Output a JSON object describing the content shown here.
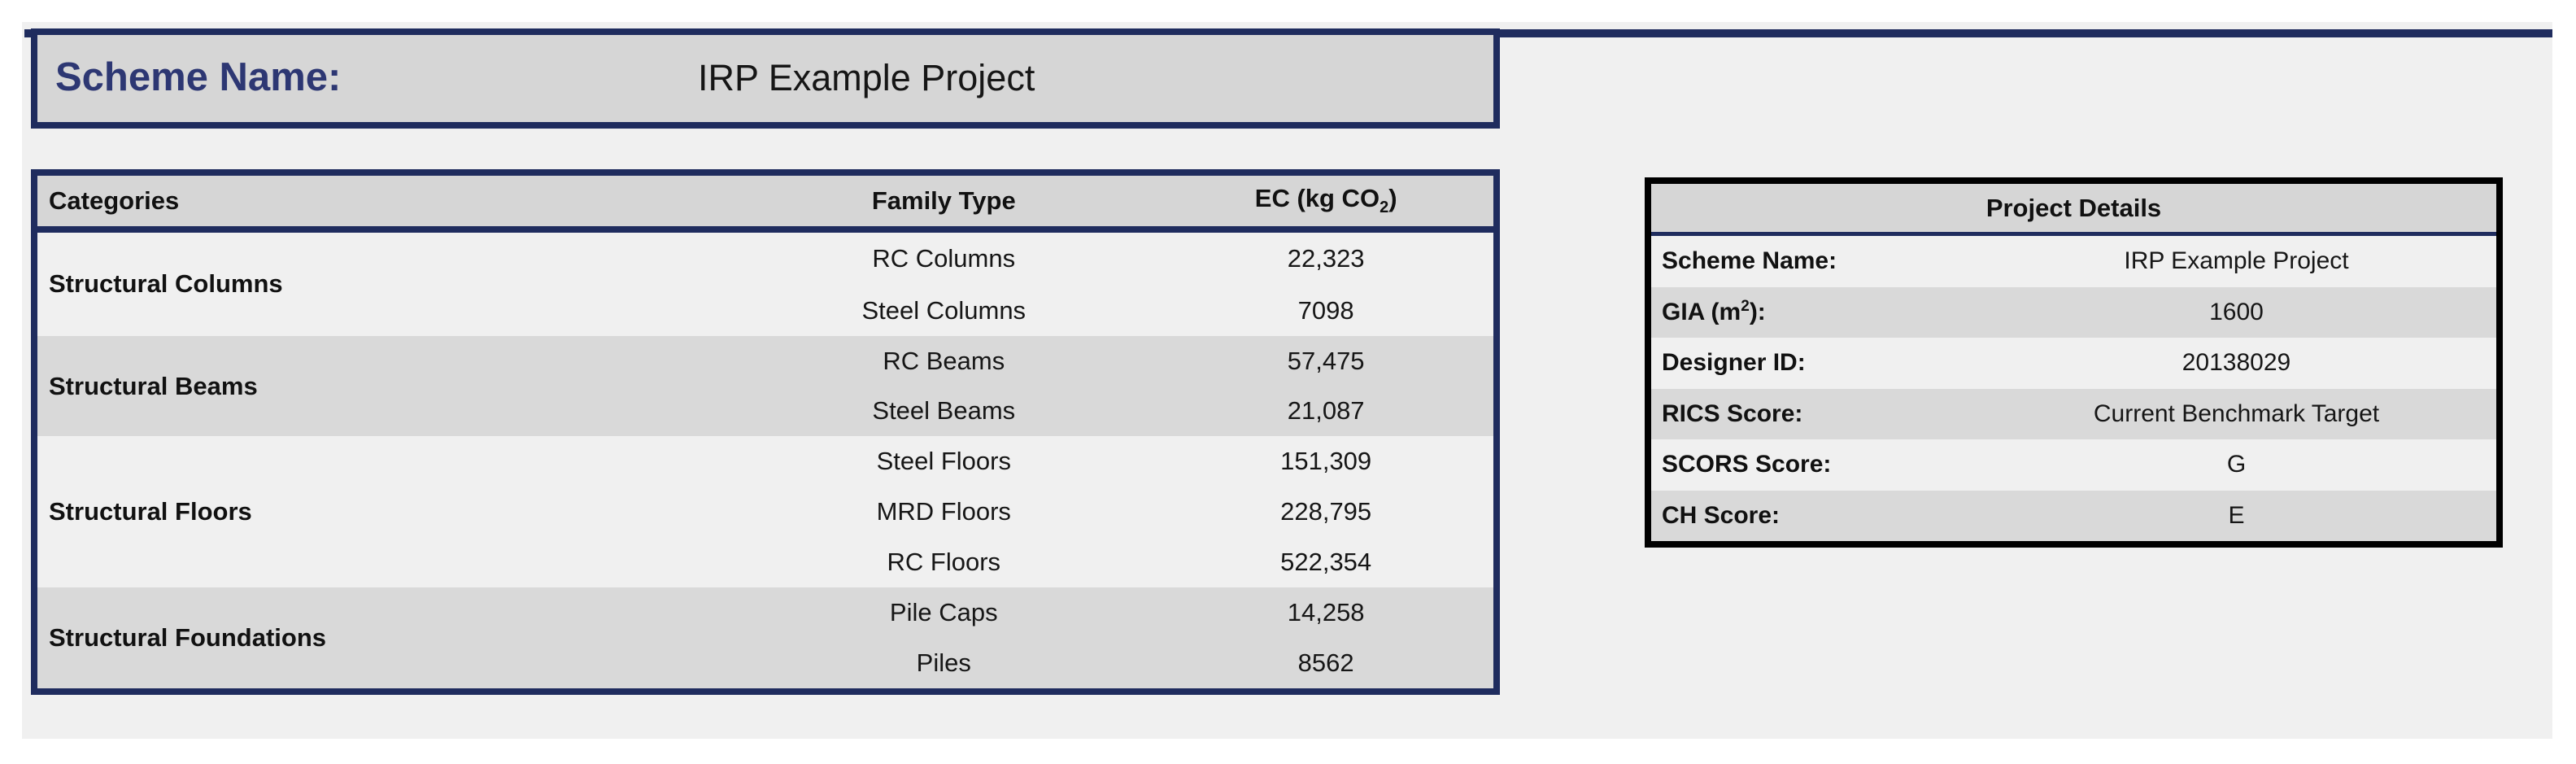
{
  "banner": {
    "label": "Scheme Name:",
    "value": "IRP Example Project"
  },
  "table": {
    "categories_header": "Categories",
    "family_header": "Family Type",
    "ec_header": {
      "prefix": "EC (kg CO",
      "sub": "2",
      "suffix": ")"
    },
    "groups": [
      {
        "category": "Structural Columns",
        "rows": [
          {
            "family": "RC Columns",
            "ec": "22,323"
          },
          {
            "family": "Steel Columns",
            "ec": "7098"
          }
        ]
      },
      {
        "category": "Structural Beams",
        "rows": [
          {
            "family": "RC Beams",
            "ec": "57,475"
          },
          {
            "family": "Steel Beams",
            "ec": "21,087"
          }
        ]
      },
      {
        "category": "Structural Floors",
        "rows": [
          {
            "family": "Steel Floors",
            "ec": "151,309"
          },
          {
            "family": "MRD Floors",
            "ec": "228,795"
          },
          {
            "family": "RC Floors",
            "ec": "522,354"
          }
        ]
      },
      {
        "category": "Structural Foundations",
        "rows": [
          {
            "family": "Pile Caps",
            "ec": "14,258"
          },
          {
            "family": "Piles",
            "ec": "8562"
          }
        ]
      }
    ]
  },
  "details": {
    "title": "Project Details",
    "scheme_name": {
      "label": "Scheme Name:",
      "value": "IRP Example Project"
    },
    "gia": {
      "label_prefix": "GIA (m",
      "label_sup": "2",
      "label_suffix": "):",
      "value": "1600"
    },
    "designer_id": {
      "label": "Designer ID:",
      "value": "20138029"
    },
    "rics": {
      "label": "RICS Score:",
      "value": "Current Benchmark Target"
    },
    "scors": {
      "label": "SCORS Score:",
      "value": "G"
    },
    "ch": {
      "label": "CH Score:",
      "value": "E"
    }
  },
  "colors": {
    "navy_border": "#1f2c5e",
    "title_blue": "#2d3773",
    "panel_border": "#000000",
    "header_gray": "#d6d6d6",
    "row_dark": "#d9d9d9",
    "row_light": "#f0f0f0"
  }
}
